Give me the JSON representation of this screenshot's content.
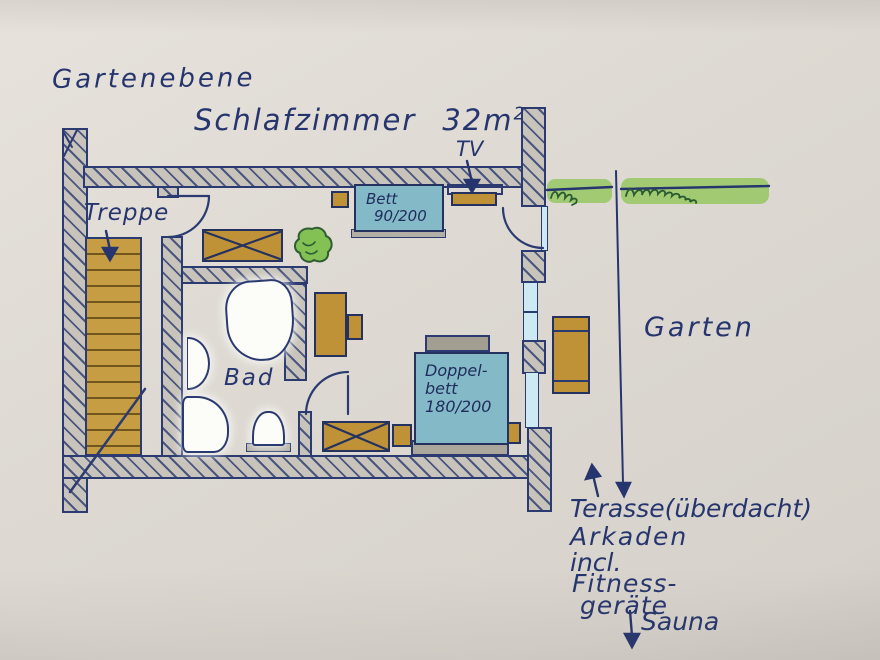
{
  "page": {
    "title": "Gartenebene"
  },
  "room": {
    "name": "Schlafzimmer",
    "area_value": "32m",
    "area_exponent": "2"
  },
  "labels": {
    "tv": "TV",
    "stairs": "Treppe",
    "bath": "Bad",
    "garden": "Garten"
  },
  "furniture": {
    "single_bed": {
      "line1": "Bett",
      "line2": "90/200"
    },
    "double_bed": {
      "line1": "Doppel-",
      "line2": "bett",
      "line3": "180/200"
    }
  },
  "annotations": {
    "terrace": "Terasse(überdacht)",
    "arcades": "Arkaden",
    "including": "incl.",
    "fitness": "Fitness-",
    "equipment": "geräte",
    "sauna": "Sauna"
  },
  "colors": {
    "paper": "#dedad3",
    "ink": "#27356e",
    "wall_fill": "#c8c4bb",
    "wood": "#bf9238",
    "bed_blue": "#84b9c8",
    "hedge_green": "#96c763",
    "plant_green": "#83c155",
    "glass_blue": "#cdeaf4",
    "fixture_white": "#fcfcf8",
    "headboard_gray": "#a39e92"
  }
}
